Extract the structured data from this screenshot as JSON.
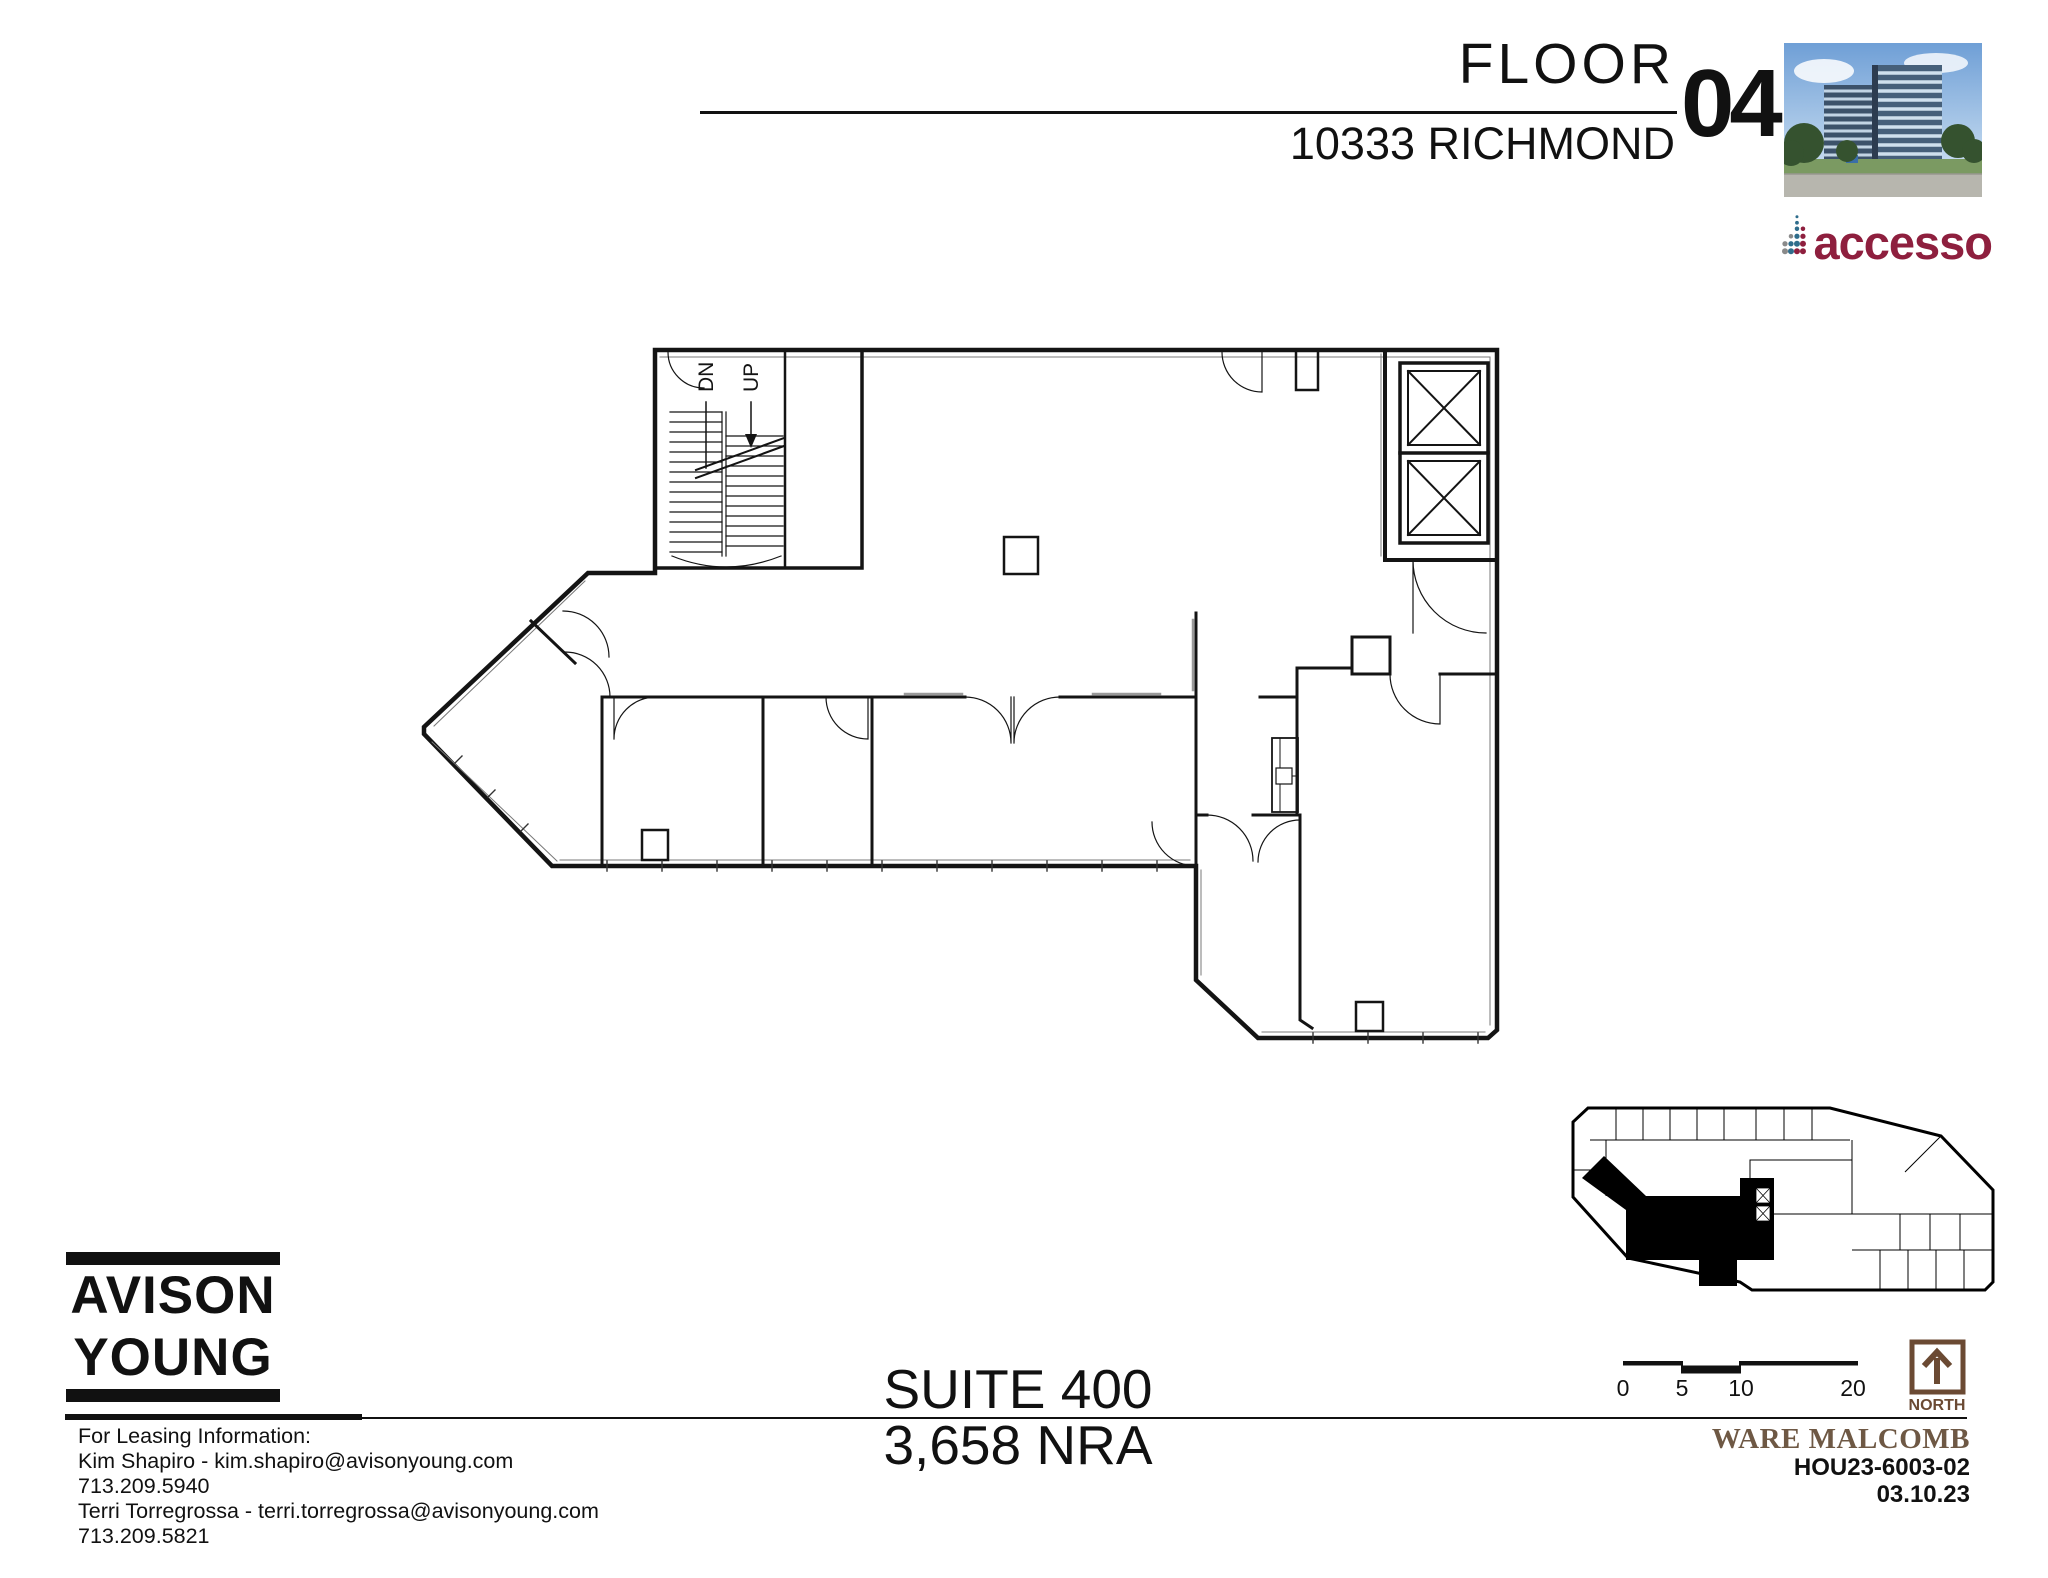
{
  "header": {
    "floor_label": "FLOOR",
    "building_address": "10333 RICHMOND",
    "floor_number": "04"
  },
  "branding": {
    "accesso_text": "accesso",
    "avison_young_line1": "AVISON",
    "avison_young_line2": "YOUNG"
  },
  "plan": {
    "stair_down_label": "DN",
    "stair_up_label": "UP"
  },
  "suite": {
    "name": "SUITE 400",
    "area": "3,658 NRA"
  },
  "leasing": {
    "lines": [
      "For Leasing Information:",
      "Kim Shapiro - kim.shapiro@avisonyoung.com",
      "713.209.5940",
      "Terri Torregrossa - terri.torregrossa@avisonyoung.com",
      "713.209.5821"
    ]
  },
  "scale_bar": {
    "labels": [
      "0",
      "5",
      "10",
      "20"
    ]
  },
  "north": {
    "label": "NORTH"
  },
  "title_block": {
    "firm": "WARE MALCOMB",
    "project_number": "HOU23-6003-02",
    "date": "03.10.23"
  },
  "colors": {
    "accesso_maroon": "#8E1F3E",
    "accesso_teal": "#2F6D8C",
    "accesso_gray": "#8A8A8A",
    "firm_brown": "#6E5844",
    "north_brown": "#6B4A33",
    "line_black": "#111111"
  }
}
